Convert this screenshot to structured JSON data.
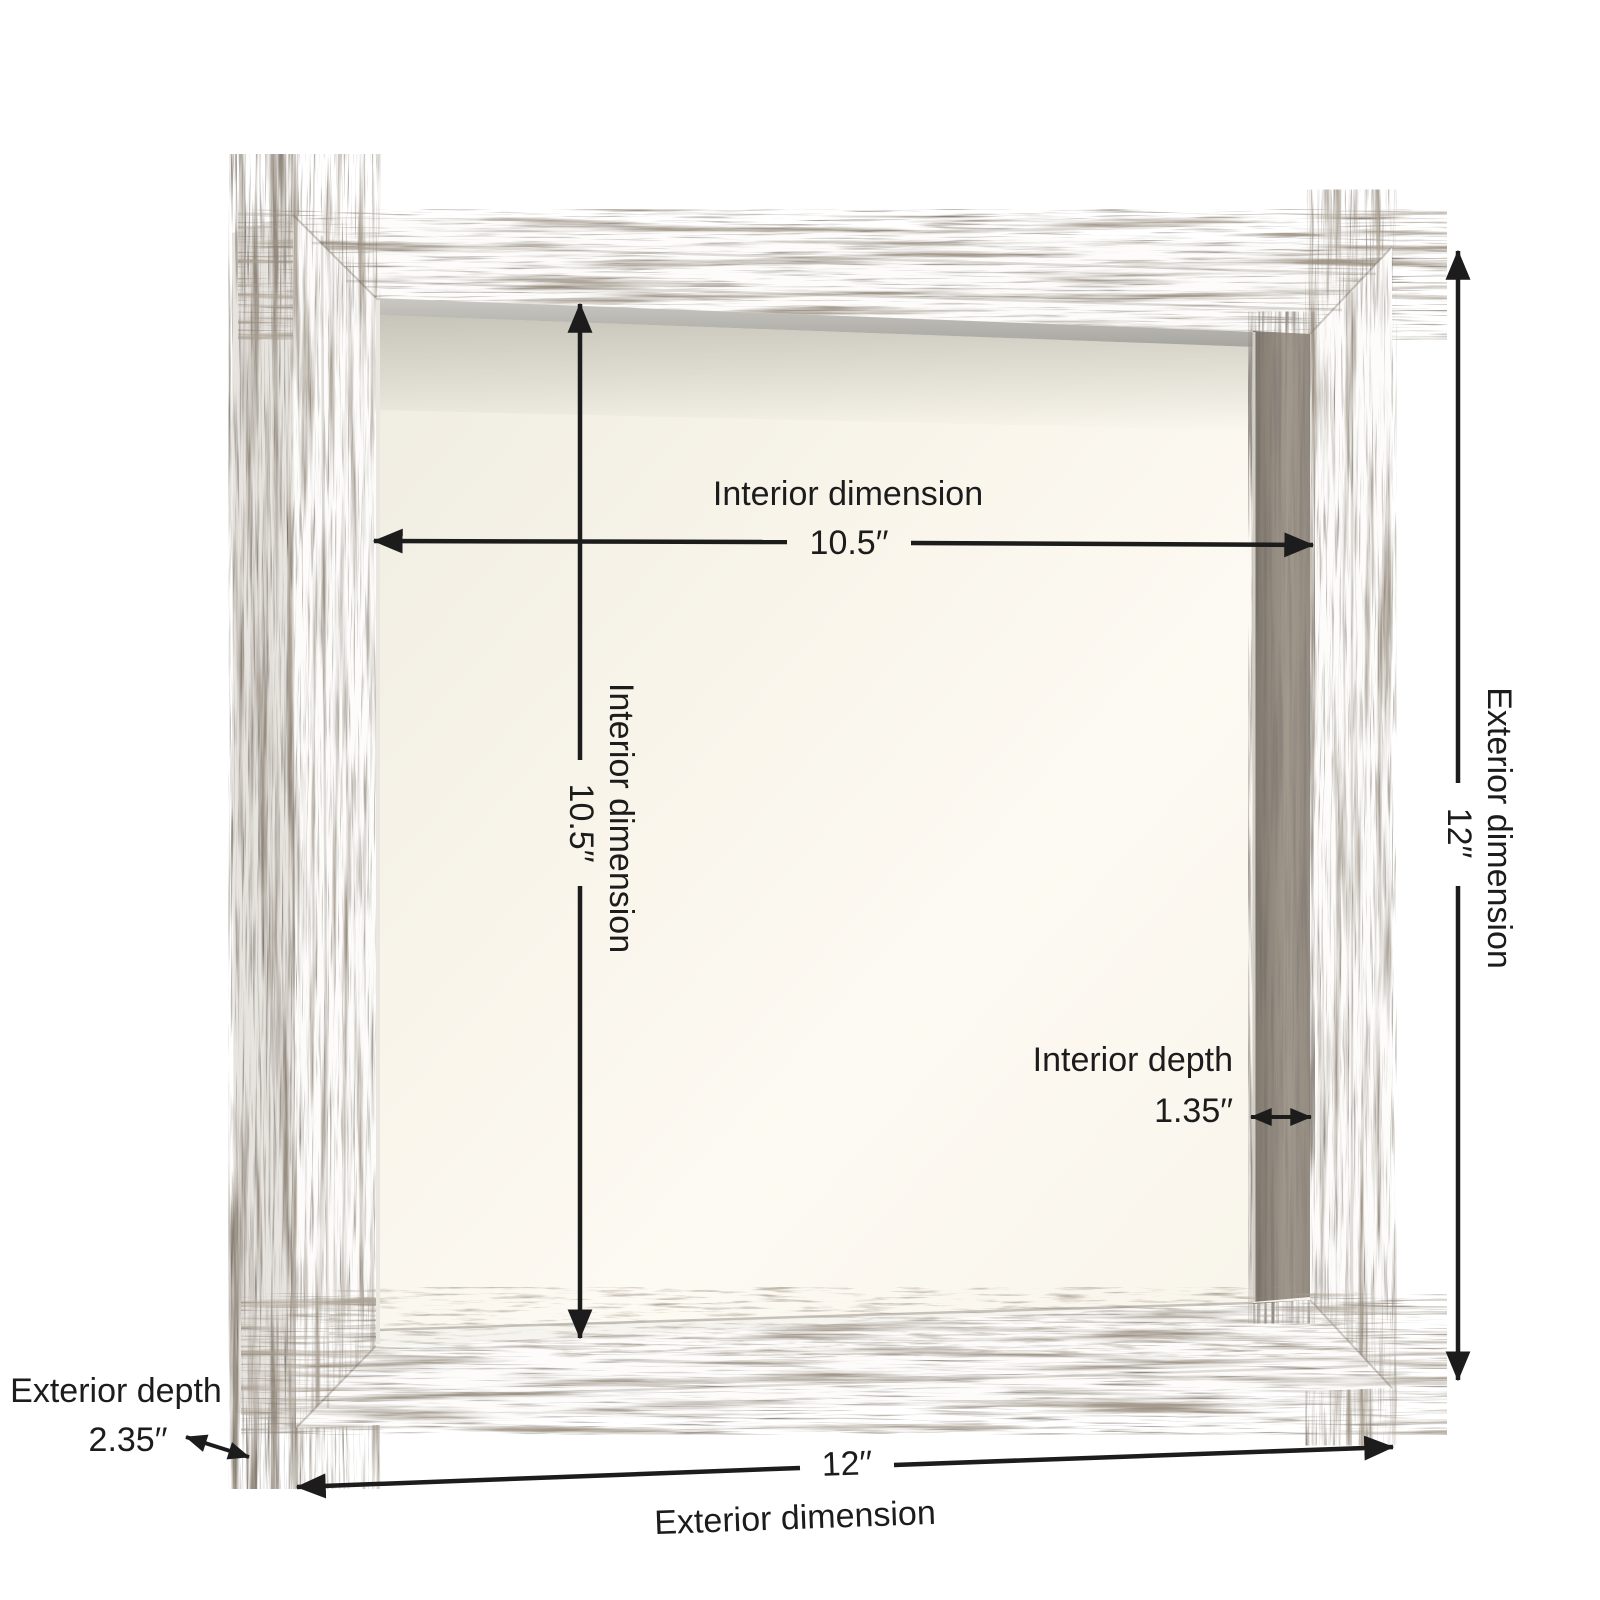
{
  "colors": {
    "page_background": "#ffffff",
    "annotation_text": "#1c1c1c",
    "arrow": "#1c1c1c",
    "frame_base": "#fdfcfa",
    "wood_streak": "#5f5244",
    "side_panel_base": "#f2efeb",
    "backing_cream": "#faf6ec",
    "inner_wall_gray": "#a89f93",
    "silver_lip": "#b9b8b2"
  },
  "annotations": {
    "interior_width": {
      "label": "Interior dimension",
      "value": "10.5′′"
    },
    "interior_height": {
      "label": "Interior dimension",
      "value": "10.5′′"
    },
    "interior_depth": {
      "label": "Interior depth",
      "value": "1.35′′"
    },
    "exterior_height": {
      "label": "Exterior dimension",
      "value": "12′′"
    },
    "exterior_width": {
      "label": "Exterior dimension",
      "value": "12′′"
    },
    "exterior_depth": {
      "label": "Exterior depth",
      "value": "2.35′′"
    }
  }
}
